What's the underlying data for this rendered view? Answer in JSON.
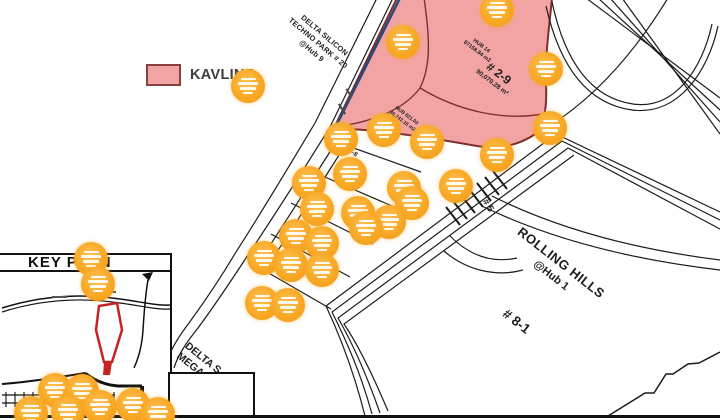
{
  "legend": {
    "kavling": "KAVLING"
  },
  "colors": {
    "kavling_fill": "#f2a4a4",
    "kavling_border": "#7d2e2e",
    "marker_orange": "#f7a824",
    "keyplan_red": "#c62222",
    "road_blue": "#2a4a7d"
  },
  "map": {
    "labels": {
      "techno_park": {
        "line1": "DELTA SILICON",
        "line2": "TECHNO PARK # 20",
        "line3": "@Hub 9"
      },
      "hub14": {
        "line1": "HUB 14",
        "line2": "87158.84 m2"
      },
      "plot_2_9": {
        "id": "# 2-9",
        "area": "90,070.28 m²"
      },
      "hub821": {
        "line1": "HUB 821.03",
        "line2": "36,742.18 m2"
      },
      "plot_2_8": "# 2-8",
      "plot_2_7": "# 2-7",
      "road_5": "# 5",
      "rolling_hills": {
        "line1": "ROLLING HILLS",
        "line2": "@Hub 1"
      },
      "plot_8_1": "# 8-1",
      "delta_mega": {
        "line1": "DELTA S",
        "line2": "MEGA"
      }
    },
    "inset": {
      "title": "KEY PLAN"
    },
    "markers": [
      [
        403,
        42
      ],
      [
        497,
        10
      ],
      [
        546,
        69
      ],
      [
        550,
        128
      ],
      [
        248,
        86
      ],
      [
        384,
        130
      ],
      [
        341,
        139
      ],
      [
        427,
        142
      ],
      [
        350,
        174
      ],
      [
        309,
        183
      ],
      [
        404,
        188
      ],
      [
        456,
        186
      ],
      [
        497,
        155
      ],
      [
        317,
        209
      ],
      [
        358,
        213
      ],
      [
        412,
        203
      ],
      [
        389,
        222
      ],
      [
        366,
        228
      ],
      [
        296,
        236
      ],
      [
        322,
        243
      ],
      [
        264,
        258
      ],
      [
        291,
        265
      ],
      [
        322,
        270
      ],
      [
        262,
        303
      ],
      [
        288,
        305
      ],
      [
        91,
        259
      ],
      [
        98,
        284
      ],
      [
        55,
        390
      ],
      [
        82,
        391
      ],
      [
        31,
        413
      ],
      [
        68,
        412
      ],
      [
        100,
        407
      ],
      [
        133,
        405
      ],
      [
        158,
        414
      ]
    ]
  }
}
